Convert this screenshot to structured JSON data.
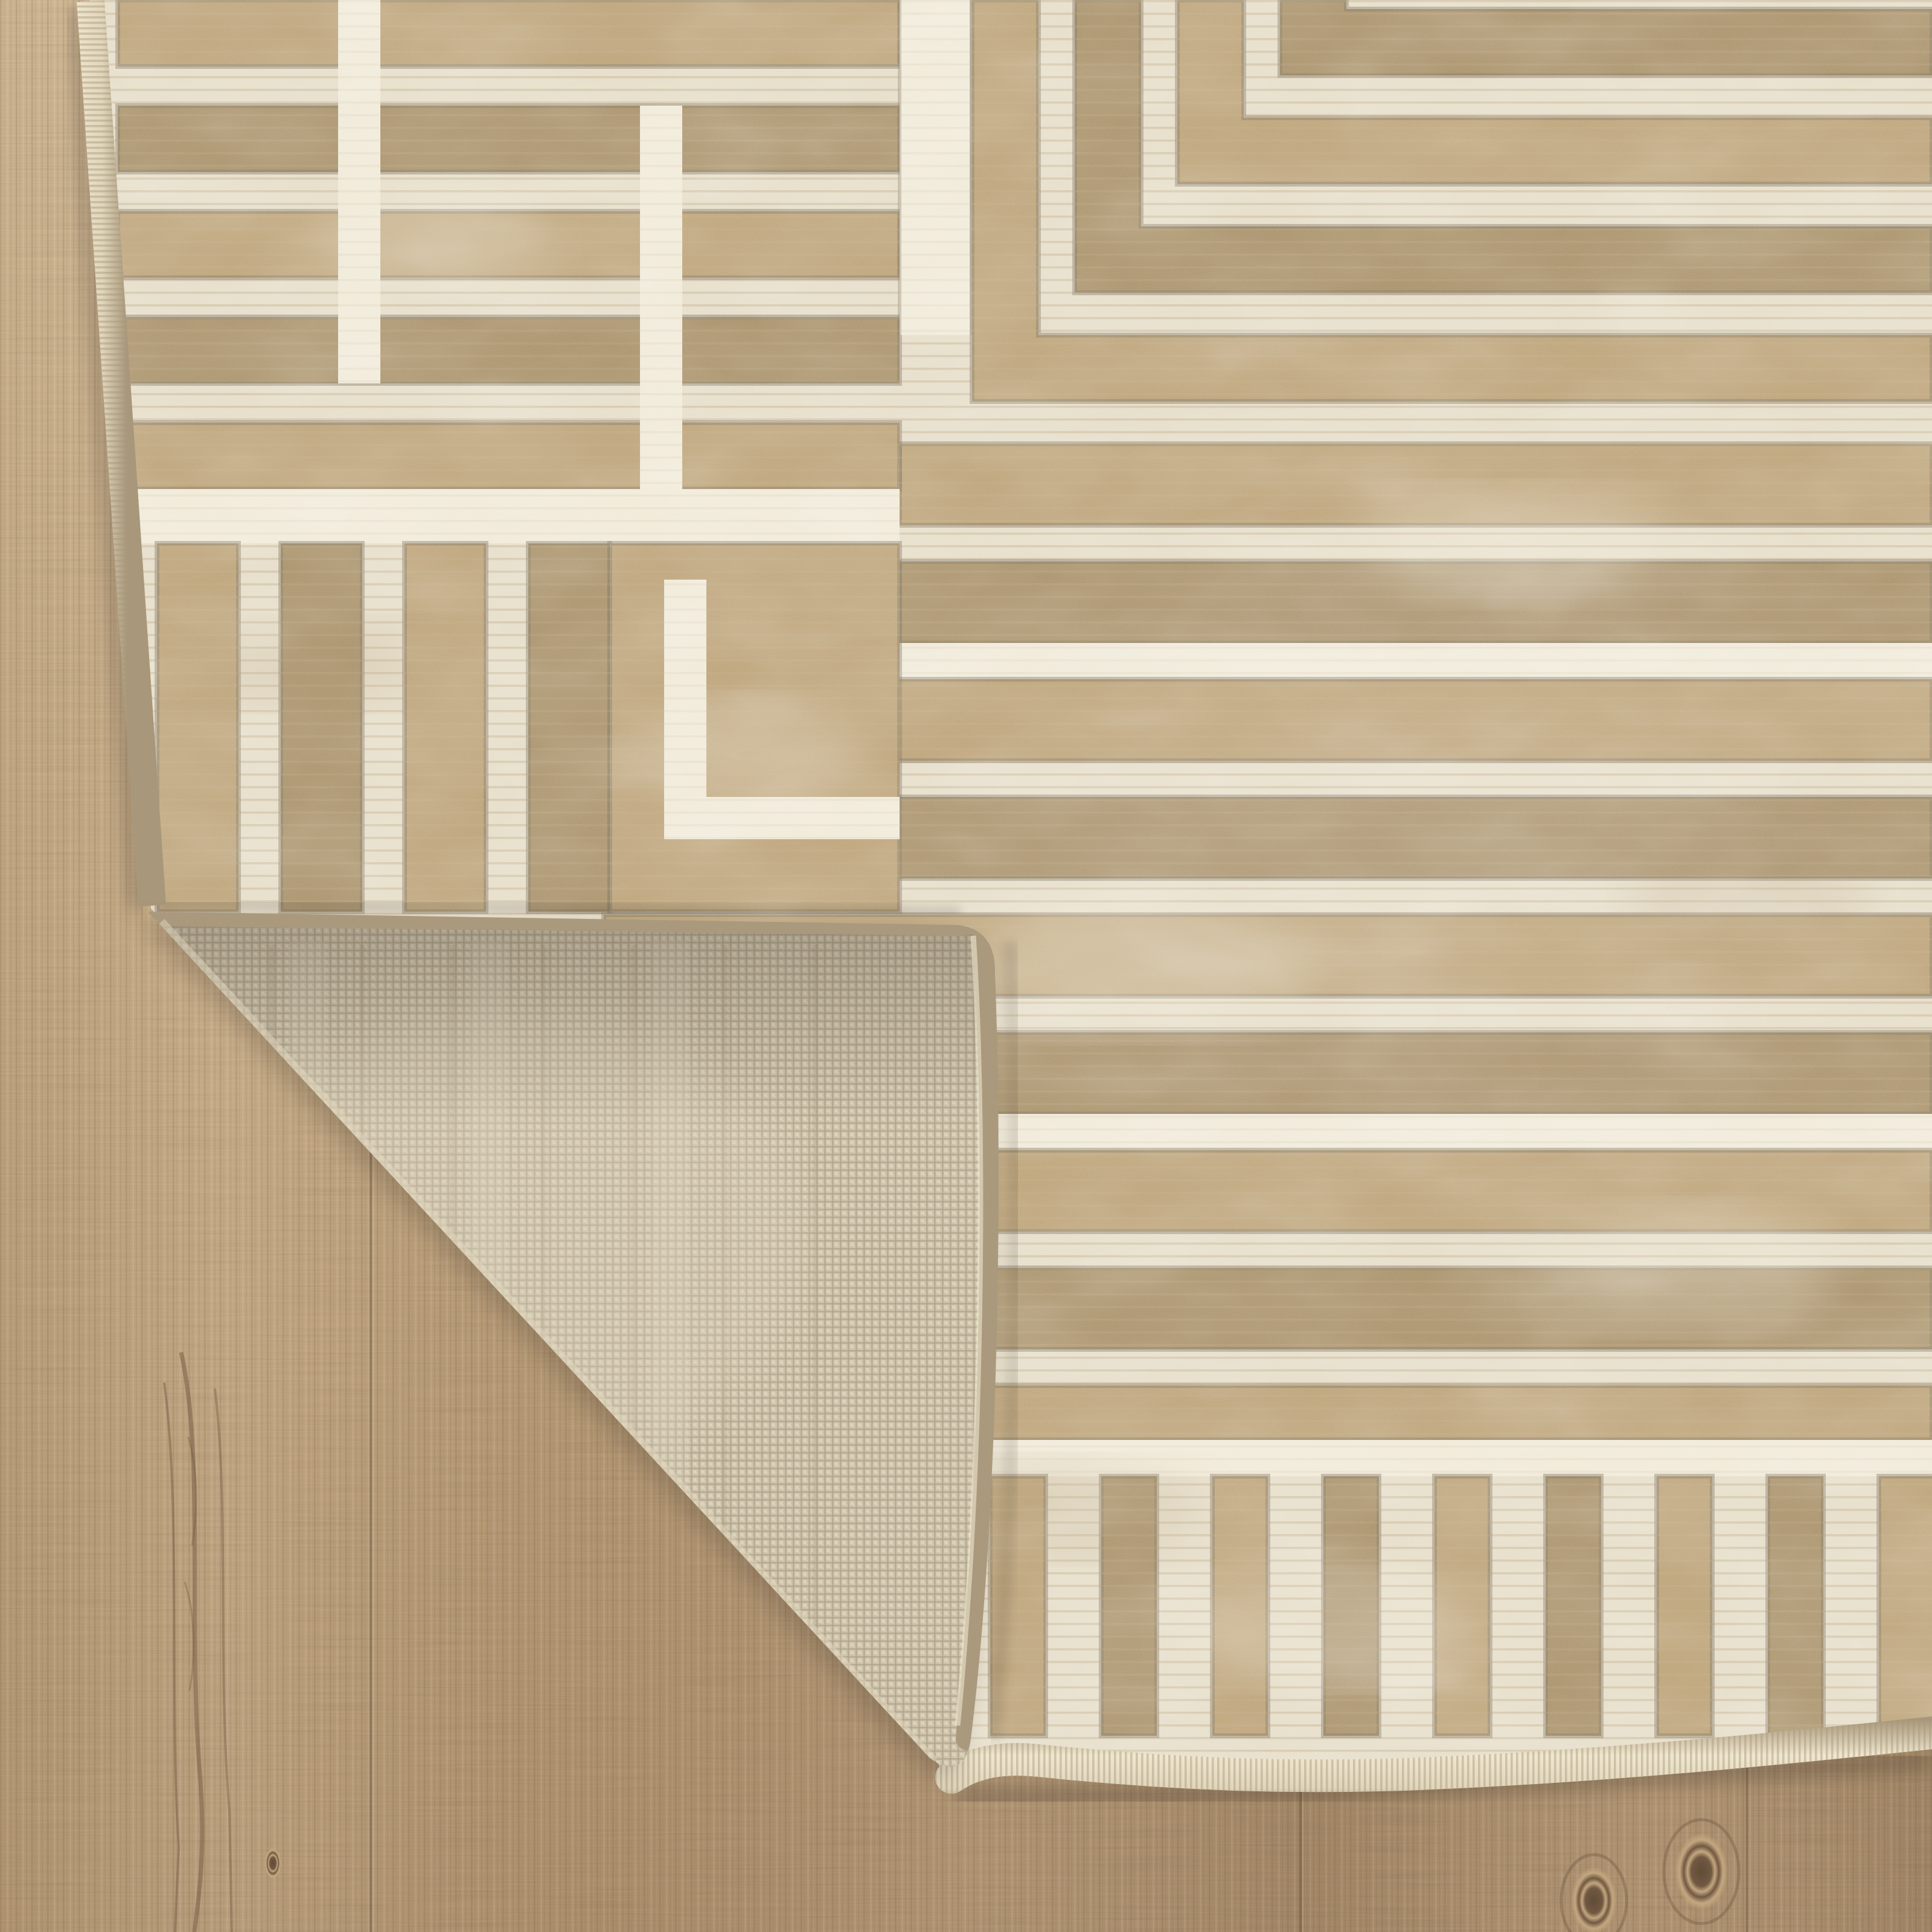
{
  "scene": {
    "subject": "Beige and ivory geometric Greek-key area rug with folded-back corner revealing woven jute backing, photographed on light oak plank flooring",
    "rug": {
      "label": "area rug front pile",
      "pattern": "distressed greek-key maze of tan bands and ivory pinstriped bands",
      "motifs": [
        "nested corner frames",
        "horizontal stripe field",
        "vertical comb bars",
        "bound selvage edges"
      ]
    },
    "folded_corner": {
      "label": "folded rug corner",
      "backing": "natural basket-weave backing with stitched bound edges"
    },
    "floor": {
      "label": "light oak wood plank floor",
      "features": [
        "vertical grain",
        "plank seams",
        "wood knots"
      ]
    }
  },
  "colors": {
    "rug_tan": "#bfa67d",
    "rug_tan_dark": "#ac9570",
    "rug_outline": "#857a66",
    "rug_cream": "#e7dfcb",
    "rug_cream_bright": "#f1ebda",
    "rug_pinstripe": "#cdbb9b",
    "selvage_light": "#e0d6bc",
    "selvage_sheen": "#efe7cf",
    "selvage_shade": "#a8977a",
    "backing_base": "#ccc1a9",
    "backing_light": "#ded4bd",
    "backing_dark": "#a99c81",
    "wood_light": "#d8bd97",
    "wood_mid": "#c3a67e",
    "wood_dark": "#ad8f6b",
    "wood_streak": "#6f5740",
    "wood_seam": "#5f4a34",
    "shadow": "#3f3categorical"
  }
}
